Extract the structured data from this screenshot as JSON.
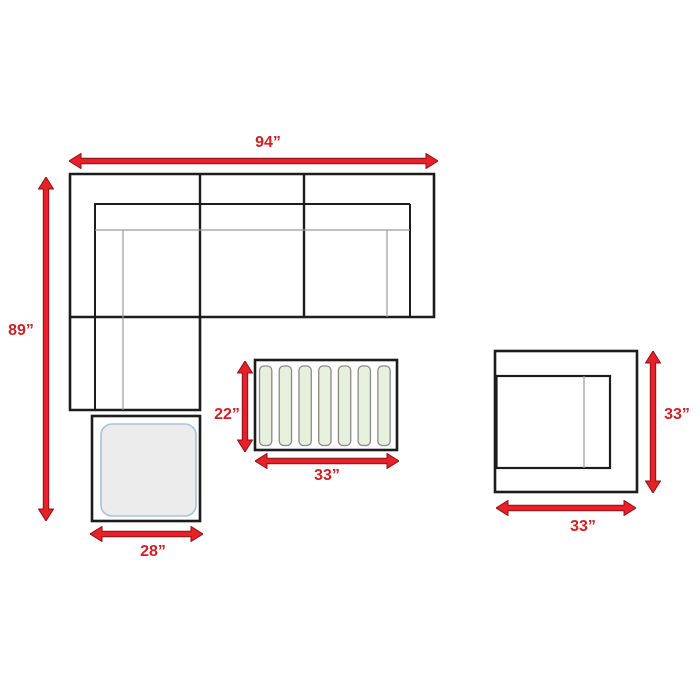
{
  "diagram": {
    "type": "furniture-dimension-diagram",
    "items": {
      "sectional_sofa": {
        "name": "sectional sofa",
        "width": "94”",
        "depth": "89”"
      },
      "ottoman": {
        "name": "ottoman",
        "width": "28”"
      },
      "coffee_table": {
        "name": "coffee table",
        "depth": "22”",
        "width": "33”"
      },
      "armchair": {
        "name": "armchair",
        "depth": "33”",
        "width": "33”"
      }
    },
    "table": {
      "slat_count": 7
    },
    "colors": {
      "background": "#ffffff",
      "arrow_fill": "#e62129",
      "arrow_stroke": "#8f1013",
      "label_text": "#ce2127",
      "outline": "#1c1c1c",
      "seam": "#9a9a9a",
      "slat_fill": "#e6f0dd",
      "slat_border": "#8a8a8a",
      "pad_fill": "#ececec",
      "pad_border": "#a9c2d8"
    }
  }
}
